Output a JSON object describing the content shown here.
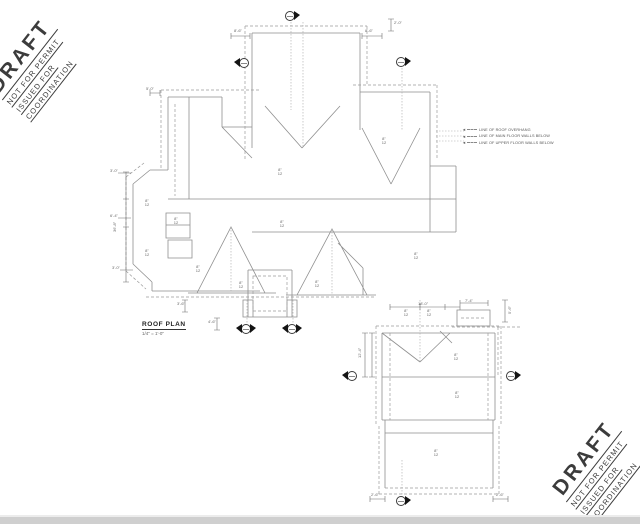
{
  "stamp": {
    "line1": "DRAFT",
    "line2": "NOT FOR PERMIT",
    "line3": "ISSUED FOR",
    "line4": "COORDINATION"
  },
  "title_block": {
    "title": "ROOF PLAN",
    "scale": "1/4\" = 1'-0\""
  },
  "legend": {
    "items": [
      {
        "label": "LINE OF ROOF OVERHANG"
      },
      {
        "label": "LINE OF MAIN FLOOR WALLS BELOW"
      },
      {
        "label": "LINE OF UPPER FLOOR WALLS BELOW"
      }
    ]
  },
  "colors": {
    "line": "#8f8f8f",
    "dashed": "#9a9a9a",
    "stamp": "#3c3c3c",
    "page_edge": "#cfcfcf"
  },
  "plan": {
    "slope_labels": [
      {
        "x": 280,
        "y": 168,
        "text": "8\"\n12"
      },
      {
        "x": 282,
        "y": 220,
        "text": "8\"\n12"
      },
      {
        "x": 147,
        "y": 199,
        "text": "8\"\n12"
      },
      {
        "x": 147,
        "y": 249,
        "text": "8\"\n12"
      },
      {
        "x": 176,
        "y": 217,
        "text": "8\"\n12"
      },
      {
        "x": 198,
        "y": 265,
        "text": "8\"\n12"
      },
      {
        "x": 241,
        "y": 281,
        "text": "8\"\n12"
      },
      {
        "x": 317,
        "y": 280,
        "text": "8\"\n12"
      },
      {
        "x": 384,
        "y": 137,
        "text": "8\"\n12"
      },
      {
        "x": 416,
        "y": 252,
        "text": "8\"\n12"
      },
      {
        "x": 406,
        "y": 309,
        "text": "8\"\n12"
      },
      {
        "x": 429,
        "y": 309,
        "text": "8\"\n12"
      },
      {
        "x": 456,
        "y": 353,
        "text": "8\"\n12"
      },
      {
        "x": 457,
        "y": 391,
        "text": "8\"\n12"
      },
      {
        "x": 436,
        "y": 449,
        "text": "8\"\n12"
      }
    ],
    "dims": [
      {
        "x": 234,
        "y": 29,
        "text": "8'-6\""
      },
      {
        "x": 365,
        "y": 29,
        "text": "8'-6\""
      },
      {
        "x": 394,
        "y": 21,
        "text": "2'-0\""
      },
      {
        "x": 113,
        "y": 232,
        "text": "36'-8\"",
        "rot": true
      },
      {
        "x": 110,
        "y": 169,
        "text": "3'-0\""
      },
      {
        "x": 110,
        "y": 214,
        "text": "6'-4\""
      },
      {
        "x": 112,
        "y": 266,
        "text": "3'-0\""
      },
      {
        "x": 146,
        "y": 87,
        "text": "5'-0\""
      },
      {
        "x": 208,
        "y": 320,
        "text": "4'-6\""
      },
      {
        "x": 177,
        "y": 302,
        "text": "3'-6\""
      },
      {
        "x": 358,
        "y": 358,
        "text": "12'-4\"",
        "rot": true
      },
      {
        "x": 418,
        "y": 302,
        "text": "18'-0\""
      },
      {
        "x": 465,
        "y": 299,
        "text": "7'-4\""
      },
      {
        "x": 508,
        "y": 314,
        "text": "5'-6\"",
        "rot": true
      },
      {
        "x": 371,
        "y": 493,
        "text": "2'-6\""
      },
      {
        "x": 496,
        "y": 493,
        "text": "2'-6\""
      }
    ],
    "markers": [
      {
        "x": 291,
        "y": 17,
        "flags": [
          "right"
        ]
      },
      {
        "x": 245,
        "y": 64,
        "flags": [
          "left"
        ]
      },
      {
        "x": 402,
        "y": 63,
        "flags": [
          "right"
        ]
      },
      {
        "x": 247,
        "y": 330,
        "flags": [
          "left",
          "right"
        ]
      },
      {
        "x": 293,
        "y": 330,
        "flags": [
          "left",
          "right"
        ]
      },
      {
        "x": 353,
        "y": 377,
        "flags": [
          "left"
        ]
      },
      {
        "x": 512,
        "y": 377,
        "flags": [
          "right"
        ]
      },
      {
        "x": 402,
        "y": 502,
        "flags": [
          "right"
        ]
      }
    ]
  }
}
